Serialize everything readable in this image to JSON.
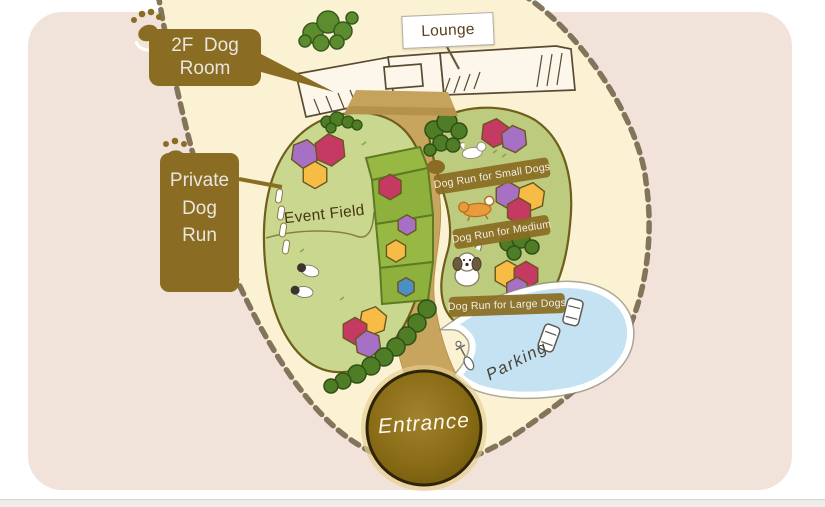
{
  "areas": {
    "lounge": {
      "label": "Lounge"
    },
    "dog_room_2f": {
      "line1": "2F  Dog",
      "line2": "Room"
    },
    "private_dog_run": {
      "line1": "Private",
      "line2": "Dog",
      "line3": "Run"
    },
    "event_field": {
      "label": "Event Field"
    },
    "dog_run_small": {
      "label": "Dog Run for Small Dogs"
    },
    "dog_run_medium": {
      "label": "Dog Run for Medium"
    },
    "dog_run_large": {
      "label": "Dog Run for Large Dogs"
    },
    "parking": {
      "label": "Parking"
    },
    "entrance": {
      "label": "Entrance"
    }
  },
  "colors": {
    "canvas_background": "#ffffff",
    "mat_pink": "#f1e3da",
    "map_cream": "#fbf2d4",
    "rope_brown": "#6f5f44",
    "sign_brown": "#8a6d22",
    "field_green": "#c9d88e",
    "run_green": "#bccb7d",
    "stand_green": "#8db13c",
    "path_tan": "#c6a35c",
    "parking_blue": "#c5e2f2",
    "entrance_brown": "#8a6c16",
    "hex_purple": "#a670c4",
    "hex_crimson": "#c43a62",
    "hex_orange": "#f6bc45",
    "hex_blue": "#4a90c4"
  },
  "icons": [
    "paw-icon",
    "tree-icon",
    "bush-icon",
    "small-dog-icon",
    "medium-dog-icon",
    "large-dog-icon",
    "puppy-icon",
    "car-icon",
    "scooter-icon"
  ]
}
